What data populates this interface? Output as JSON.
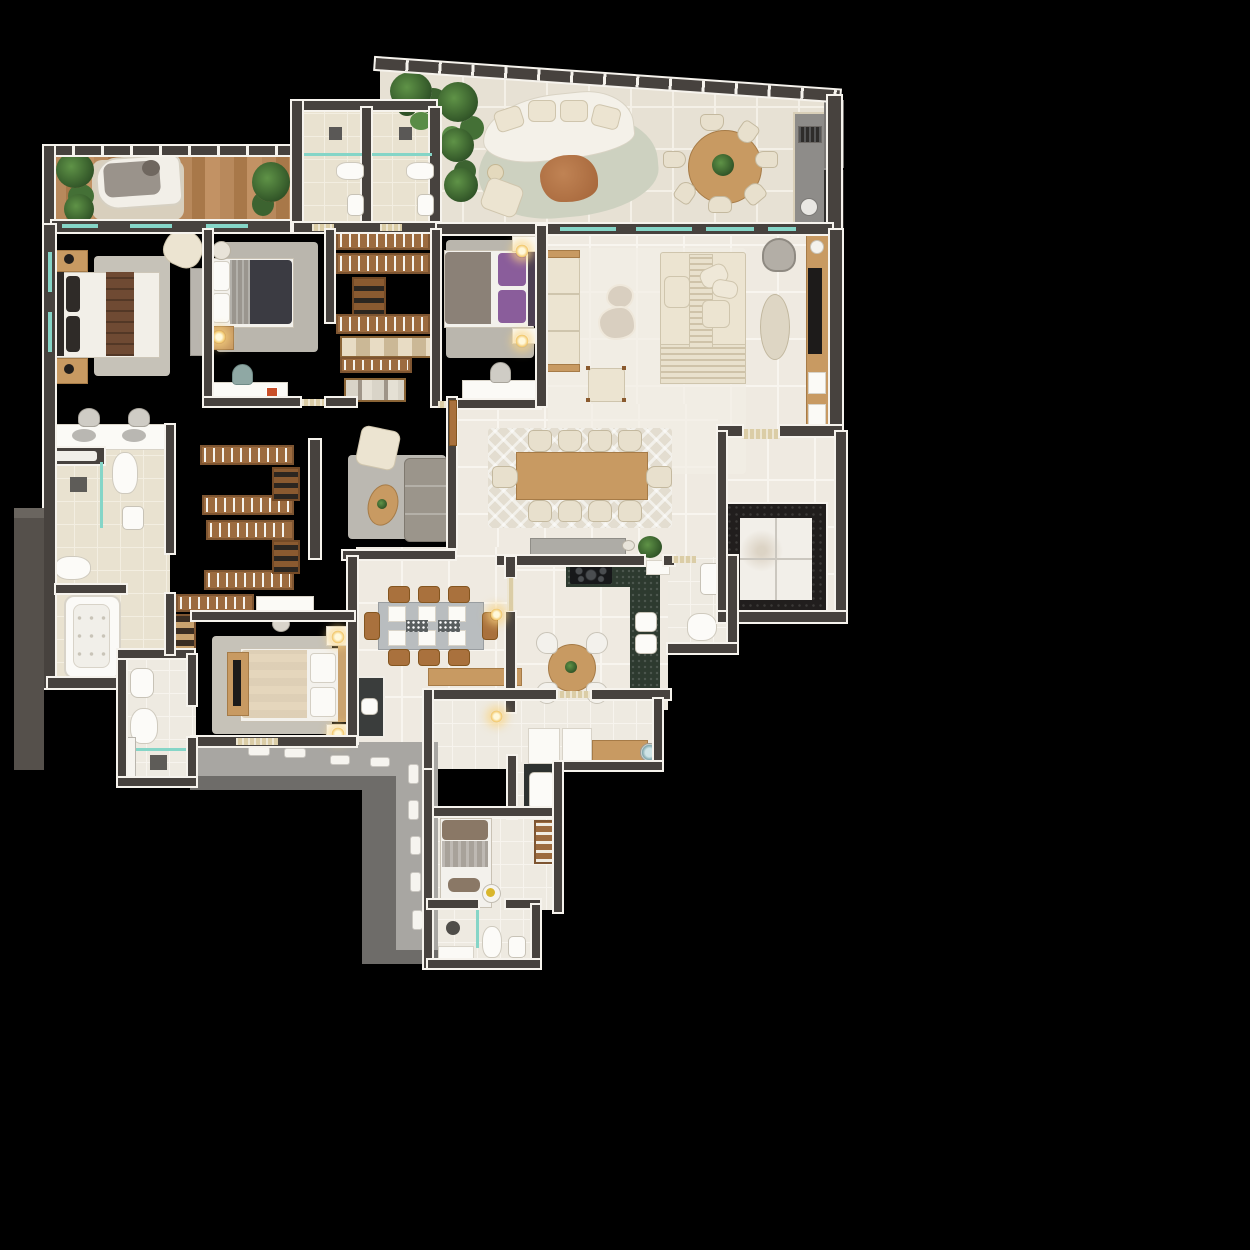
{
  "scene": {
    "type": "apartment-floor-plan-3d-render",
    "view": "top-down",
    "background": "#000000",
    "visible_text": "none"
  },
  "palette": {
    "background": "#000000",
    "wall": "#47423e",
    "wallDark": "#332f2c",
    "wallEdge": "#f6f3ed",
    "woodFloor": "#b5855a",
    "tileCream": "#efeae1",
    "tileTerrace": "#e7e1d4",
    "tileBath": "#e9e2d0",
    "tileWhite": "#eeeae1",
    "corridor": "#a8a6a2",
    "corridorDark": "#6e6c69",
    "granite": "#2d3a2f",
    "elevatorGranite": "#211e1d",
    "marble": "#f2efe9",
    "glassTeal": "#85d5c7",
    "plantDark": "#2f5226",
    "plantLight": "#5f9347",
    "woodFurniture": "#c89a62",
    "closetWood": "#9c6b3f",
    "sofaCream": "#ece4d1",
    "rugLight": "#e9e4d8",
    "rugGray": "#cfccc4",
    "rugChevron": "#e3ddd0",
    "bedNavy": "#3b3b42",
    "bedPurple": "#8a5d9b",
    "bedBrownRunner": "#6f4a33",
    "bedBeige": "#e5d6bc",
    "counterGray": "#b9bdbf",
    "stoneGray": "#8e8c89",
    "sand": "#dbcda6",
    "glowLamp": "#f2c76a",
    "terraceRug": "#cdd1c0",
    "coffeeTableRust": "#b97a4a"
  },
  "rooms": [
    {
      "id": "terrace",
      "furniture": [
        "curved-white-sofa",
        "oval-rug",
        "organic-coffee-table",
        "side-table",
        "lounge-chair",
        "round-dining-table",
        "dining-chairs-x7",
        "barbecue-counter",
        "grill",
        "bar-sink",
        "potted-plants"
      ]
    },
    {
      "id": "left-balcony",
      "furniture": [
        "daybed",
        "shag-rug",
        "potted-plants-x3",
        "railing"
      ]
    },
    {
      "id": "bathroom-top-1",
      "furniture": [
        "shower-head",
        "glass-partition",
        "toilet",
        "pedestal-sink"
      ]
    },
    {
      "id": "bathroom-top-2",
      "furniture": [
        "shower-head",
        "glass-partition",
        "toilet",
        "pedestal-sink"
      ]
    },
    {
      "id": "master-bedroom",
      "furniture": [
        "double-bed-brown-runner",
        "nightstands-x2",
        "lamps",
        "area-rug",
        "tv-panel",
        "armchair"
      ]
    },
    {
      "id": "bedroom-2",
      "furniture": [
        "double-bed-charcoal",
        "round-side-table",
        "nightstand-lamp",
        "area-rug",
        "desk",
        "desk-chair"
      ]
    },
    {
      "id": "walk-in-closet-1",
      "furniture": [
        "hanger-racks-x4",
        "shoe-shelves",
        "basket-shelf",
        "folded-clothes-shelf"
      ]
    },
    {
      "id": "bedroom-3",
      "furniture": [
        "double-bed-purple",
        "nightstands-x2",
        "glow-lamps",
        "area-rug",
        "desk",
        "desk-chair"
      ]
    },
    {
      "id": "living-room",
      "furniture": [
        "cream-sofa",
        "organic-ottomans-x2",
        "accent-chair",
        "slatted-lounge-deck",
        "lounge-cushions",
        "hanging-swing-chair",
        "oval-travertine-table",
        "wood-sideboard",
        "flat-tv",
        "area-rug"
      ]
    },
    {
      "id": "dining-room",
      "furniture": [
        "long-wood-table",
        "dining-chairs-x10",
        "chevron-rug",
        "stone-console",
        "plant",
        "bowl"
      ]
    },
    {
      "id": "elevator-hall",
      "furniture": [
        "entry-threshold",
        "private-elevator-marble-cab",
        "granite-frame"
      ]
    },
    {
      "id": "kitchen",
      "furniture": [
        "granite-l-counter",
        "cooktop-5-burners",
        "double-sink",
        "round-table",
        "white-chairs-x4",
        "pass-through-counter"
      ]
    },
    {
      "id": "breakfast-area",
      "furniture": [
        "gray-top-table",
        "wood-chairs-x8",
        "place-settings",
        "dark-bar-counter",
        "bar-sink",
        "wood-sideboard"
      ]
    },
    {
      "id": "powder-room",
      "furniture": [
        "counter-sink",
        "toilet"
      ]
    },
    {
      "id": "master-bathroom",
      "furniture": [
        "double-vanity",
        "vanity-stools-x2",
        "shower-drain",
        "glass-partitions",
        "toilet",
        "bidet-sink",
        "wc-toilet",
        "bathtub"
      ]
    },
    {
      "id": "walk-in-closet-2",
      "furniture": [
        "hanger-racks-x5",
        "shoe-shelves",
        "shoe-boxes",
        "vanity-desk",
        "stool"
      ]
    },
    {
      "id": "sitting-nook",
      "furniture": [
        "armchair",
        "oval-coffee-table",
        "gray-sofa",
        "area-rug"
      ]
    },
    {
      "id": "bedroom-4",
      "furniture": [
        "double-bed-beige",
        "nightstands-x2",
        "glow-lamps",
        "tv-board",
        "area-rug"
      ]
    },
    {
      "id": "bathroom-4",
      "furniture": [
        "sink",
        "toilet",
        "glass-partition",
        "shower-drain",
        "door-panel"
      ]
    },
    {
      "id": "service-corridor",
      "furniture": [
        "door-leaves-white",
        "thresholds"
      ]
    },
    {
      "id": "laundry",
      "furniture": [
        "white-cabinet",
        "white-appliance",
        "wood-counter",
        "washing-machine",
        "dark-counter",
        "laundry-tank-sink"
      ]
    },
    {
      "id": "service-bedroom",
      "furniture": [
        "single-bed",
        "round-side-table",
        "shoe-rack"
      ]
    },
    {
      "id": "service-bathroom",
      "furniture": [
        "shower-head",
        "glass-partition",
        "toilet",
        "sink",
        "bath-mat"
      ]
    }
  ]
}
